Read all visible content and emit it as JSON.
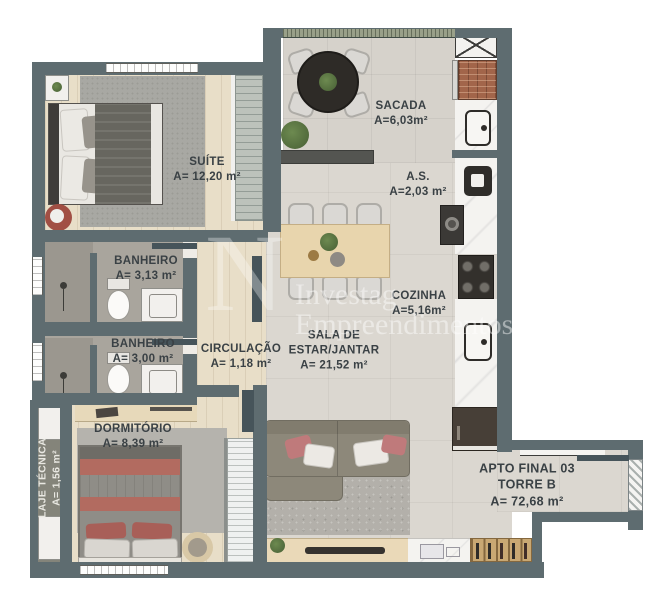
{
  "plan": {
    "watermark": {
      "logo_letter": "N",
      "line1": "Investag",
      "line2": "Empreendimentos"
    },
    "apartment": {
      "line1": "APTO FINAL 03",
      "line2": "TORRE B",
      "area": "A= 72,68 m²"
    },
    "rooms": {
      "suite": {
        "name": "SUÍTE",
        "area": "A= 12,20 m²"
      },
      "banheiro1": {
        "name": "BANHEIRO",
        "area": "A= 3,13 m²"
      },
      "banheiro2": {
        "name": "BANHEIRO",
        "area": "A= 3,00 m²"
      },
      "circulacao": {
        "name": "CIRCULAÇÃO",
        "area": "A= 1,18 m²"
      },
      "sala": {
        "name_line1": "SALA DE",
        "name_line2": "ESTAR/JANTAR",
        "area": "A= 21,52 m²"
      },
      "cozinha": {
        "name": "COZINHA",
        "area": "A=5,16m²"
      },
      "sacada": {
        "name": "SACADA",
        "area": "A=6,03m²"
      },
      "as": {
        "name": "A.S.",
        "area": "A=2,03 m²"
      },
      "dormitorio": {
        "name": "DORMITÓRIO",
        "area": "A= 8,39 m²"
      },
      "laje": {
        "name": "LAJE TÉCNICA",
        "area": "A= 1,56 m²"
      }
    },
    "colors": {
      "wall": "#5e6c70",
      "wood_floor": "#e8dec8",
      "tile_floor": "#dbd7d0",
      "label_text": "#3a4145",
      "sofa": "#8d887a",
      "accent_pillow": "#bf7a7b",
      "accent_side_table": "#a14f44"
    }
  }
}
